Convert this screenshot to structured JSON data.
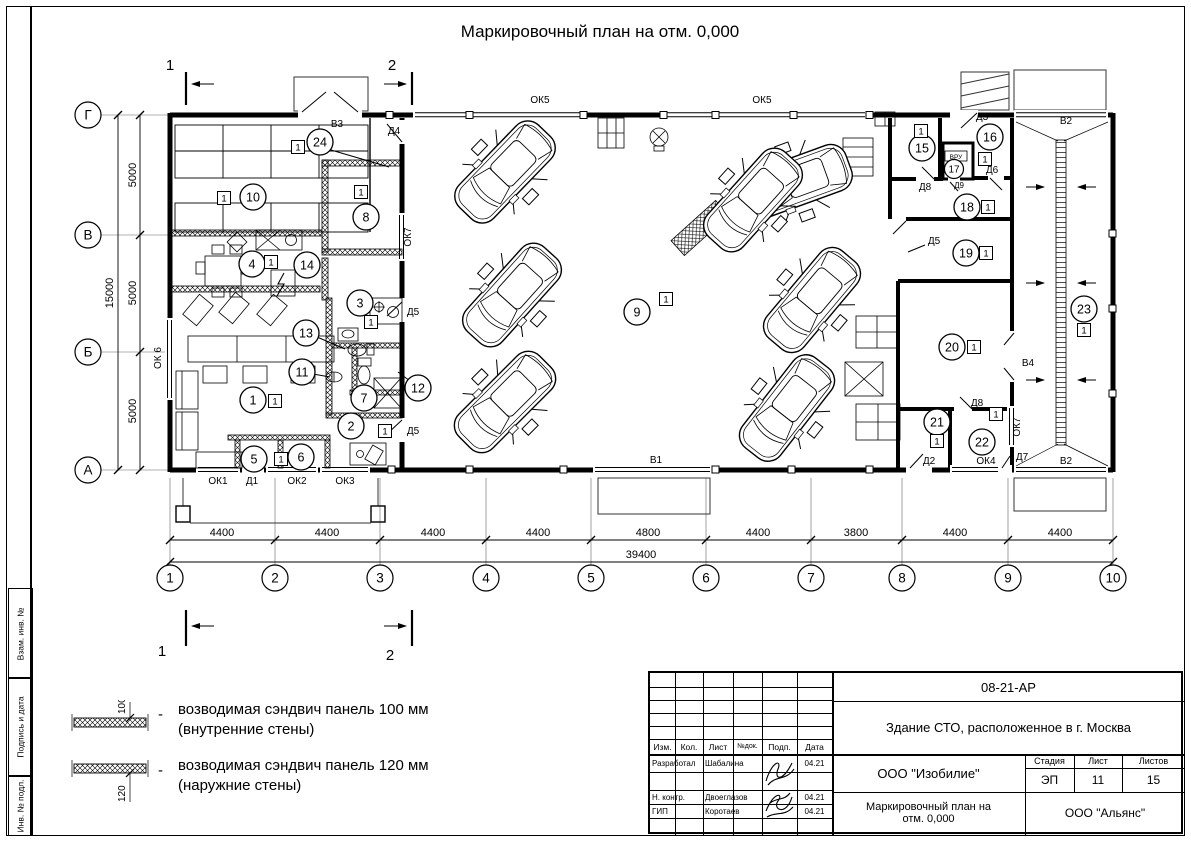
{
  "drawing_title": "Маркировочный план на отм. 0,000",
  "grid": {
    "columns": [
      "1",
      "2",
      "3",
      "4",
      "5",
      "6",
      "7",
      "8",
      "9",
      "10"
    ],
    "rows": [
      "Г",
      "В",
      "Б",
      "А"
    ],
    "column_dims": [
      "4400",
      "4400",
      "4400",
      "4400",
      "4800",
      "4400",
      "3800",
      "4400",
      "4400"
    ],
    "overall_width": "39400",
    "row_dims": [
      "5000",
      "5000",
      "5000"
    ],
    "overall_height": "15000"
  },
  "section_marks": {
    "one": "1",
    "two": "2"
  },
  "room_numbers": [
    "1",
    "2",
    "3",
    "4",
    "5",
    "6",
    "7",
    "8",
    "9",
    "10",
    "11",
    "12",
    "13",
    "14",
    "15",
    "16",
    "17",
    "18",
    "19",
    "20",
    "21",
    "22",
    "23",
    "24"
  ],
  "floor_badge": "1",
  "openings": {
    "ok1": "ОК1",
    "ok2": "ОК2",
    "ok3": "ОК3",
    "ok4": "ОК4",
    "ok5": "ОК5",
    "ok6": "ОК 6",
    "ok7": "ОК7",
    "d1": "Д1",
    "d2": "Д2",
    "d3": "Д3",
    "d4": "Д4",
    "d5": "Д5",
    "d6": "Д6",
    "d7": "Д7",
    "d8": "Д8",
    "d9": "Д9",
    "v1": "В1",
    "v2": "В2",
    "v3": "В3",
    "v4": "В4",
    "vru": "ВРУ"
  },
  "legend": {
    "items": [
      {
        "dim": "100",
        "dash": "-",
        "line1": "возводимая сэндвич панель 100 мм",
        "line2": "(внутренние стены)"
      },
      {
        "dim": "120",
        "dash": "-",
        "line1": "возводимая сэндвич панель 120 мм",
        "line2": "(наружние стены)"
      }
    ]
  },
  "title_block": {
    "doc_number": "08-21-АР",
    "project_title": "Здание СТО, расположенное в г. Москва",
    "cols": [
      "Изм.",
      "Кол.",
      "Лист",
      "№док.",
      "Подп.",
      "Дата"
    ],
    "rows": [
      {
        "role": "Разработал",
        "name": "Шабалина",
        "date": "04.21"
      },
      {
        "role": "Н. контр.",
        "name": "Двоеглазов",
        "date": "04.21"
      },
      {
        "role": "ГИП",
        "name": "Коротаев",
        "date": "04.21"
      }
    ],
    "company": "ООО \"Изобилие\"",
    "stage_label": "Стадия",
    "sheet_label": "Лист",
    "sheets_label": "Листов",
    "stage": "ЭП",
    "sheet": "11",
    "sheets": "15",
    "sheet_title": "Маркировочный план на отм. 0,000",
    "contractor": "ООО \"Альянс\""
  },
  "frame_labels": {
    "vzam": "Взам. инв. №",
    "podpis": "Подпись и дата",
    "inv": "Инв. № подл."
  }
}
